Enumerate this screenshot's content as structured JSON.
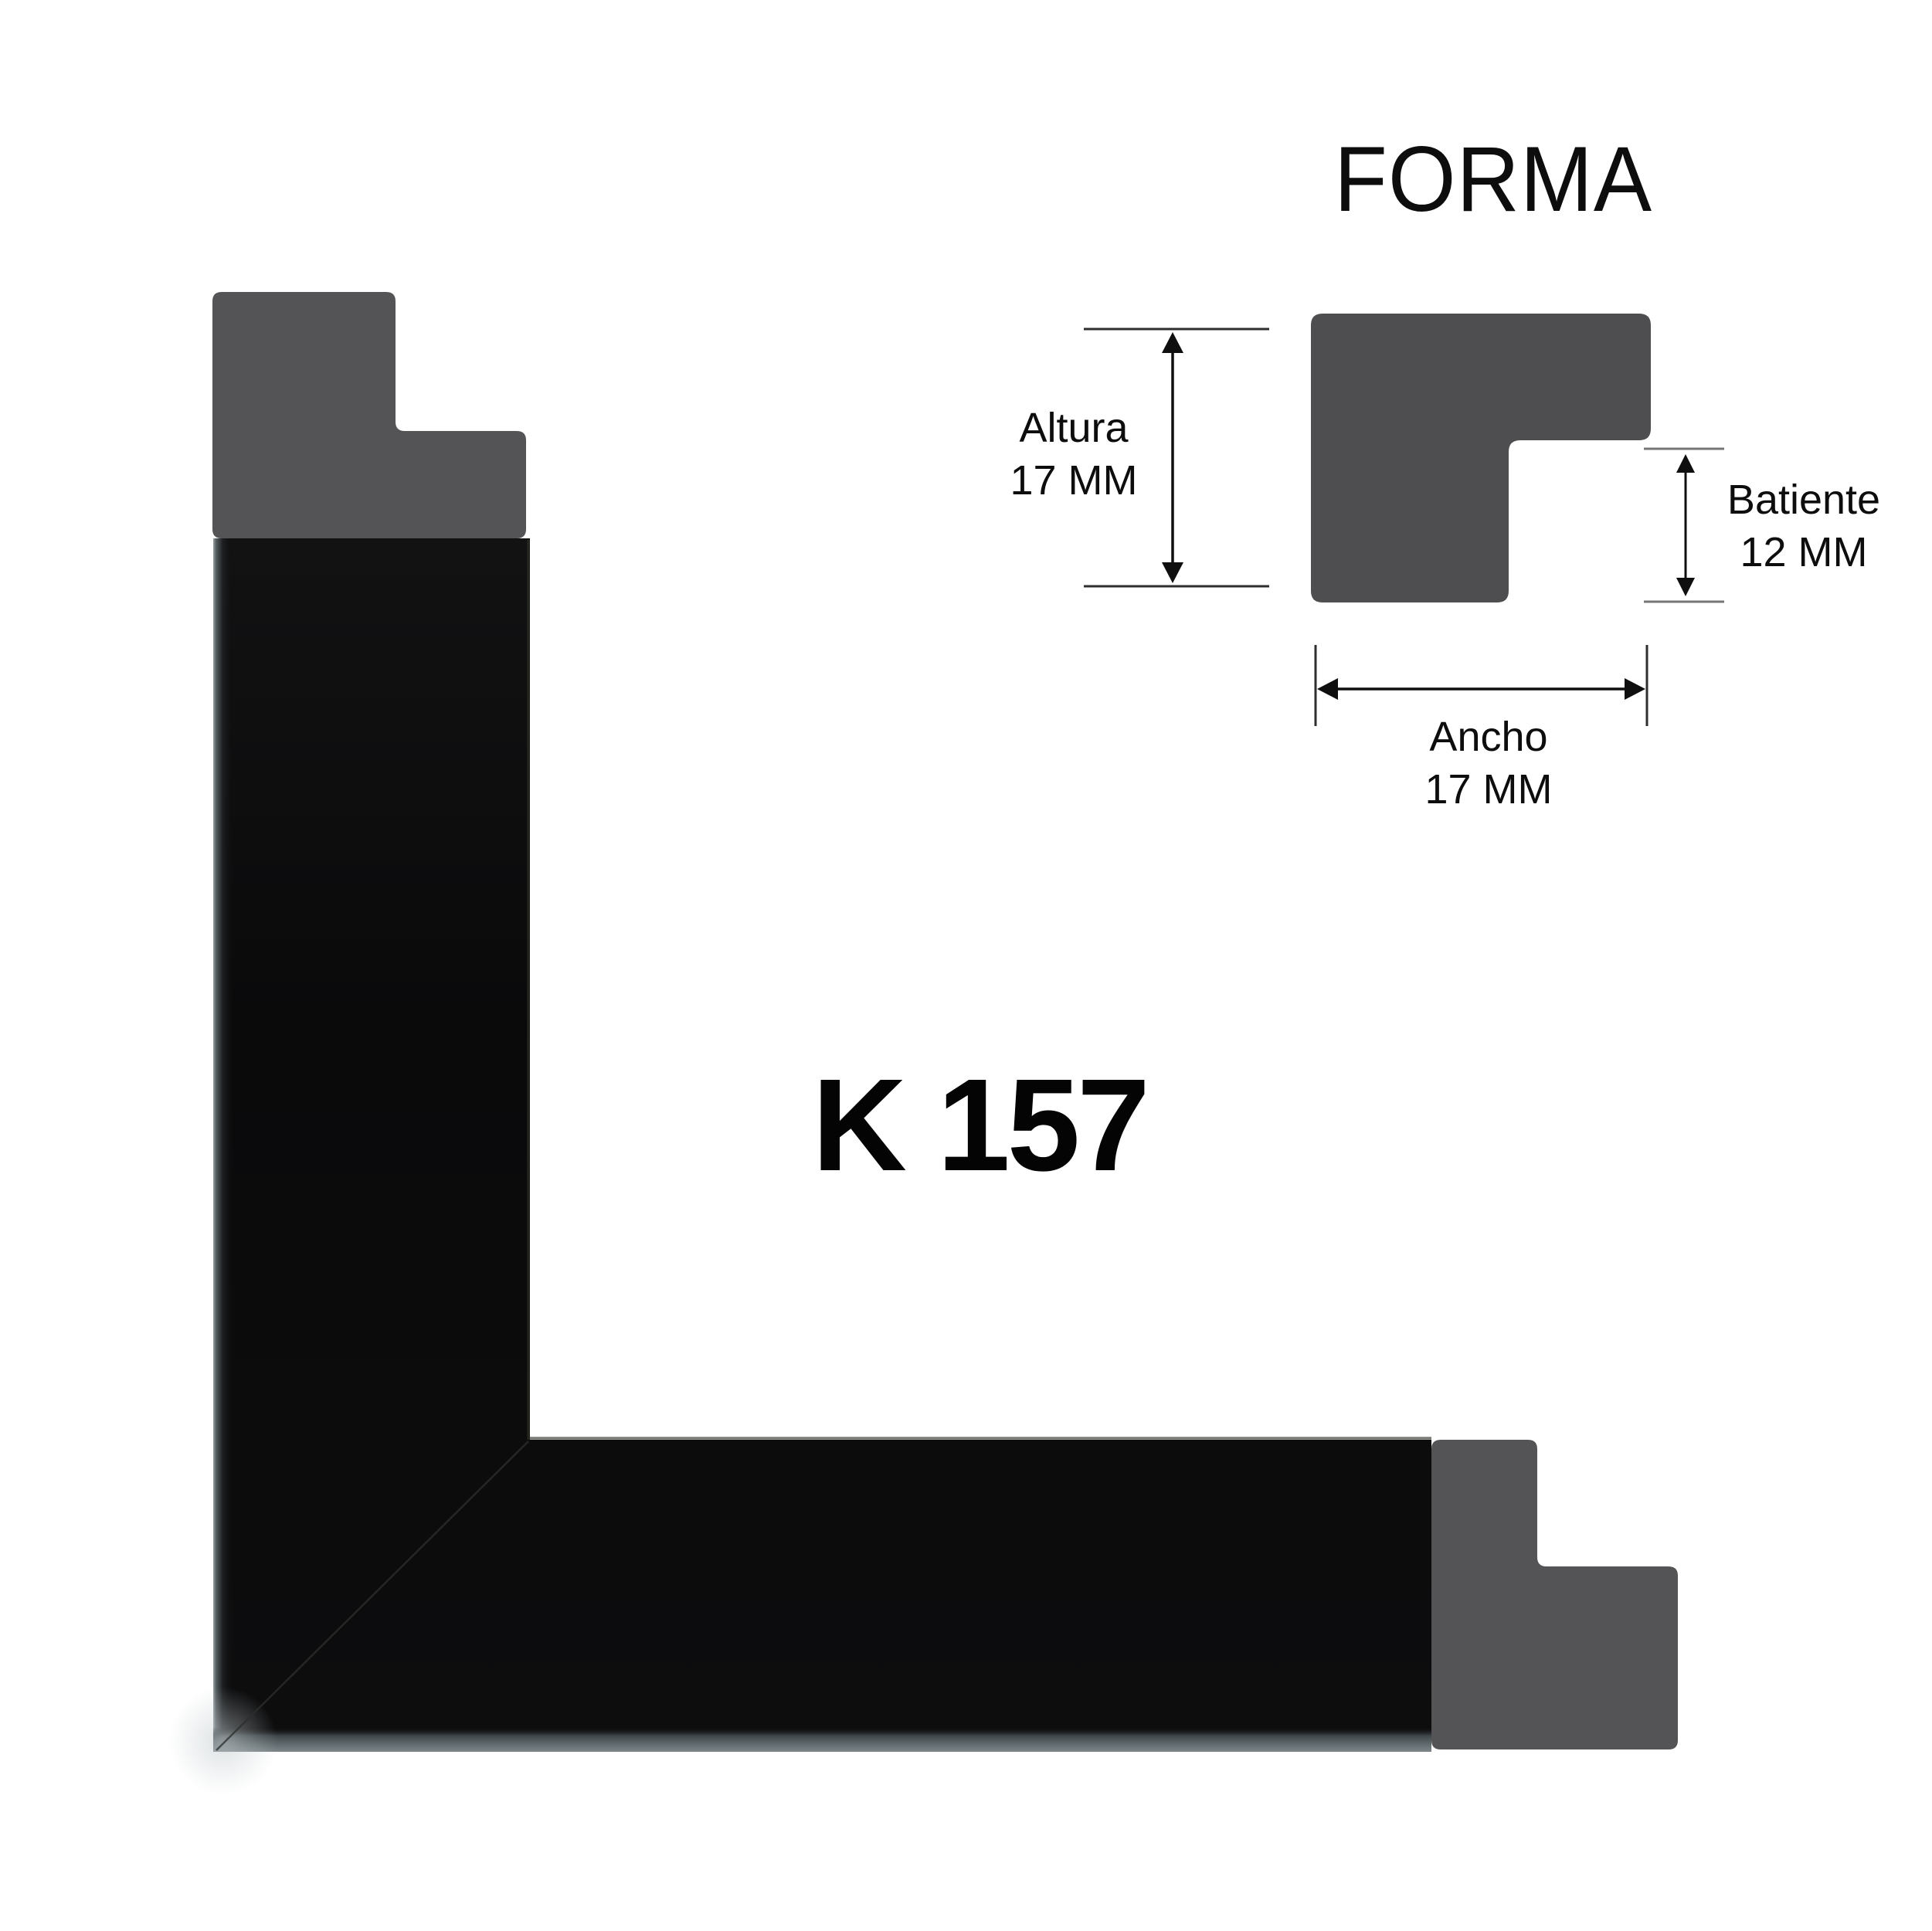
{
  "header": {
    "title": "FORMA"
  },
  "product": {
    "code": "K 157"
  },
  "profile_diagram": {
    "altura": {
      "label": "Altura",
      "value": "17 MM"
    },
    "batiente": {
      "label": "Batiente",
      "value": "12 MM"
    },
    "ancho": {
      "label": "Ancho",
      "value": "17 MM"
    }
  },
  "colors": {
    "background": "#ffffff",
    "diagram_profile_gray": "#4e4e50",
    "endcap_gray": "#545456",
    "frame_black": "#0c0c0d",
    "edge_highlight_gray": "#7e868a",
    "text_black": "#0d0d0d"
  }
}
